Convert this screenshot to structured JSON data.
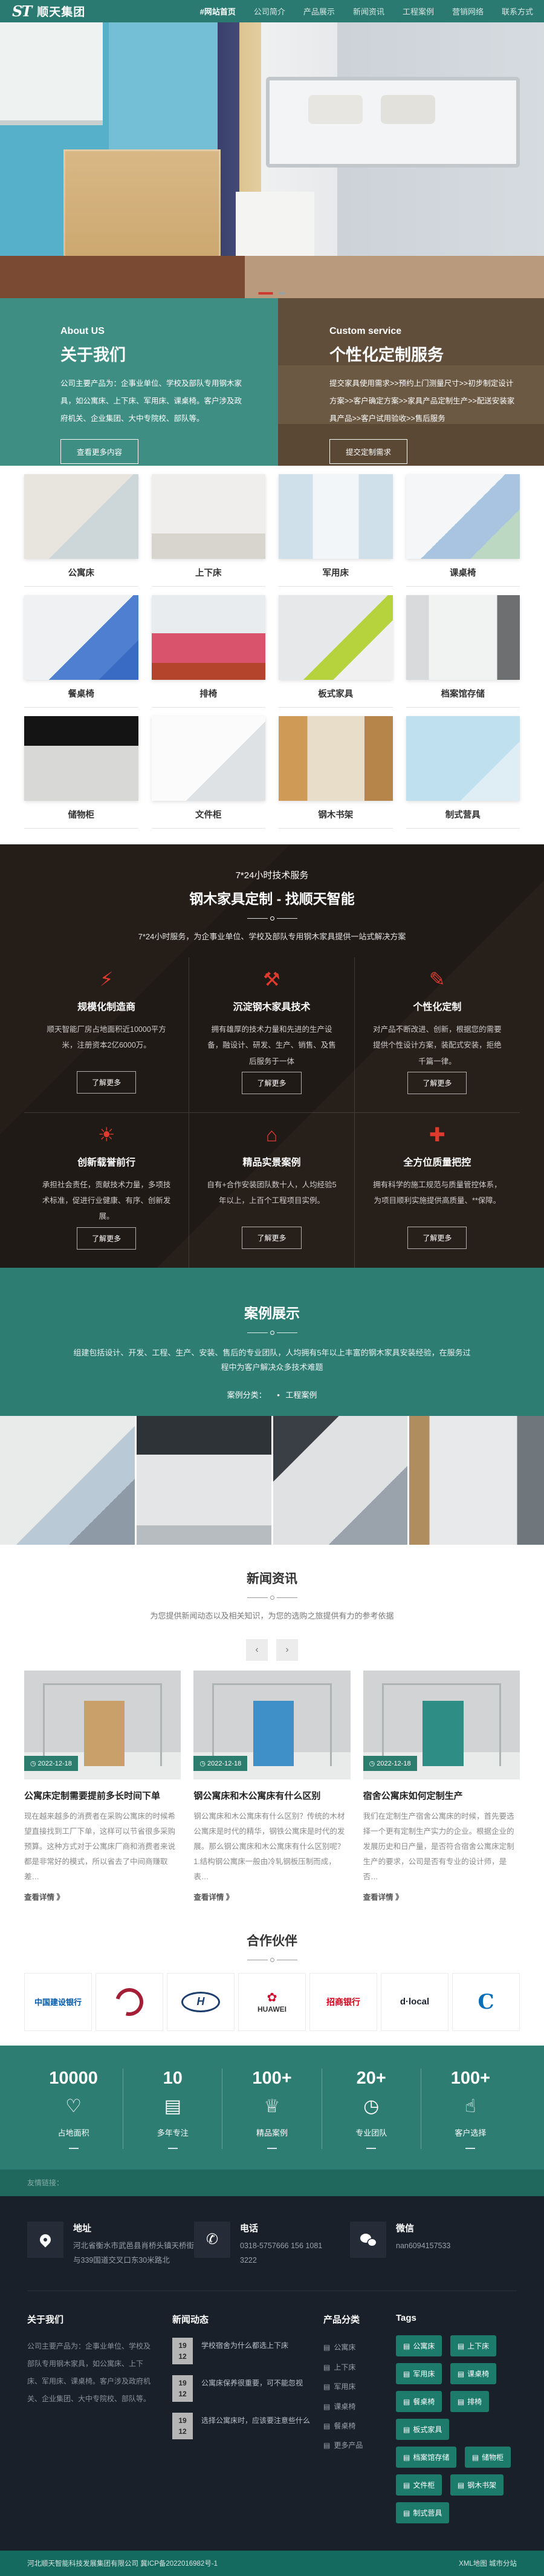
{
  "nav": {
    "logo_mark": "ST",
    "logo_text": "顺天集团",
    "items": [
      {
        "label": "#网站首页"
      },
      {
        "label": "公司简介"
      },
      {
        "label": "产品展示"
      },
      {
        "label": "新闻资讯"
      },
      {
        "label": "工程案例"
      },
      {
        "label": "营销网络"
      },
      {
        "label": "联系方式"
      }
    ]
  },
  "about": {
    "left": {
      "en": "About US",
      "title": "关于我们",
      "text": "公司主要产品为：企事业单位、学校及部队专用钢木家具，如公寓床、上下床、军用床、课桌椅。客户涉及政府机关、企业集团、大中专院校、部队等。",
      "button": "查看更多内容"
    },
    "right": {
      "en": "Custom service",
      "title": "个性化定制服务",
      "text": "提交家具使用需求>>预约上门测量尺寸>>初步制定设计方案>>客户确定方案>>家具产品定制生产>>配送安装家具产品>>客户试用验收>>售后服务",
      "button": "提交定制需求"
    }
  },
  "products": [
    "公寓床",
    "上下床",
    "军用床",
    "课桌椅",
    "餐桌椅",
    "排椅",
    "板式家具",
    "档案馆存储",
    "储物柜",
    "文件柜",
    "钢木书架",
    "制式营具"
  ],
  "services": {
    "small_title": "7*24小时技术服务",
    "title": "钢木家具定制 - 找顺天智能",
    "subtitle": "7*24小时服务，为企事业单位、学校及部队专用钢木家具提供一站式解决方案",
    "cards": [
      {
        "icon": "plug-icon",
        "glyph": "⚡",
        "title": "规模化制造商",
        "text": "顺天智能厂房占地面积近10000平方米，注册资本2亿6000万。",
        "button": "了解更多"
      },
      {
        "icon": "hammer-icon",
        "glyph": "⚒",
        "title": "沉淀钢木家具技术",
        "text": "拥有雄厚的技术力量和先进的生产设备，融设计、研发、生产、销售、及售后服务于一体",
        "button": "了解更多"
      },
      {
        "icon": "paint-roller-icon",
        "glyph": "✎",
        "title": "个性化定制",
        "text": "对产品不断改进、创新，根据您的需要提供个性设计方案，装配式安装，拒绝千篇一律。",
        "button": "了解更多"
      },
      {
        "icon": "sun-icon",
        "glyph": "☀",
        "title": "创新载誉前行",
        "text": "承担社会责任，贡献技术力量，多项技术标准，促进行业健康、有序、创新发展。",
        "button": "了解更多"
      },
      {
        "icon": "house-icon",
        "glyph": "⌂",
        "title": "精品实景案例",
        "text": "自有+合作安装团队数十人，人均经验5年以上，上百个工程项目实例。",
        "button": "了解更多"
      },
      {
        "icon": "extinguisher-icon",
        "glyph": "✚",
        "title": "全方位质量把控",
        "text": "拥有科学的施工规范与质量管控体系，为项目顺利实施提供高质量、**保障。",
        "button": "了解更多"
      }
    ]
  },
  "cases": {
    "title": "案例展示",
    "subtitle": "组建包括设计、开发、工程、生产、安装、售后的专业团队，人均拥有5年以上丰富的钢木家具安装经验，在服务过程中为客户解决众多技术难题",
    "filter_label": "案例分类：",
    "filter_bullet": "•",
    "filter_value": "工程案例"
  },
  "news": {
    "title": "新闻资讯",
    "subtitle": "为您提供新闻动态以及相关知识，为您的选购之旅提供有力的参考依据",
    "prev": "‹",
    "next": "›",
    "items": [
      {
        "date": "◷ 2022-12-18",
        "title": "公寓床定制需要提前多长时间下单",
        "text": "现在越来越多的消费者在采购公寓床的时候希望直接找到工厂下单，这样可以节省很多采购预算。这种方式对于公寓床厂商和消费者来说都是非常好的模式，所以省去了中间商赚取差…",
        "more": "查看详情 》"
      },
      {
        "date": "◷ 2022-12-18",
        "title": "钢公寓床和木公寓床有什么区别",
        "text": "钢公寓床和木公寓床有什么区别？传统的木材公寓床是时代的精华，钢铁公寓床是时代的发展。那么钢公寓床和木公寓床有什么区别呢？1.结构钢公寓床一般由冷轧钢板压制而成，表…",
        "more": "查看详情 》"
      },
      {
        "date": "◷ 2022-12-18",
        "title": "宿舍公寓床如何定制生产",
        "text": "我们在定制生产宿舍公寓床的时候，首先要选择一个更有定制生产实力的企业。根据企业的发展历史和日产量，是否符合宿舍公寓床定制生产的要求，公司是否有专业的设计师，是否…",
        "more": "查看详情 》"
      }
    ]
  },
  "partners": {
    "title": "合作伙伴",
    "logos": [
      {
        "name": "china-construction-bank",
        "text": "中国建设银行"
      },
      {
        "name": "red-emblem",
        "text": ""
      },
      {
        "name": "hyundai",
        "text": "H"
      },
      {
        "name": "huawei",
        "flower": "✿",
        "text": "HUAWEI"
      },
      {
        "name": "china-merchants-bank",
        "text": "招商银行"
      },
      {
        "name": "dlocal",
        "text": "d·local"
      },
      {
        "name": "c-logo",
        "text": "C"
      }
    ]
  },
  "stats": {
    "items": [
      {
        "value": "10000",
        "icon": "heart-icon",
        "glyph": "♡",
        "label": "占地面积"
      },
      {
        "value": "10",
        "icon": "clipboard-icon",
        "glyph": "▤",
        "label": "多年专注"
      },
      {
        "value": "100+",
        "icon": "crown-icon",
        "glyph": "♕",
        "label": "精品案例"
      },
      {
        "value": "20+",
        "icon": "stopwatch-icon",
        "glyph": "◷",
        "label": "专业团队"
      },
      {
        "value": "100+",
        "icon": "thumb-up-icon",
        "glyph": "☝",
        "label": "客户选择"
      }
    ]
  },
  "links_strip": {
    "label": "友情链接："
  },
  "footer": {
    "contacts": [
      {
        "icon": "location-pin-icon",
        "title": "地址",
        "text": "河北省衡水市武邑县肖桥头镇天桥街与339国道交叉口东30米路北"
      },
      {
        "icon": "phone-icon",
        "title": "电话",
        "text": "0318-5757666 156 1081 3222"
      },
      {
        "icon": "wechat-icon",
        "title": "微信",
        "text": "nan6094157533"
      }
    ],
    "about": {
      "title": "关于我们",
      "text": "公司主要产品为：企事业单位、学校及部队专用钢木家具，如公寓床、上下床、军用床、课桌椅。客户涉及政府机关、企业集团、大中专院校、部队等。"
    },
    "news": {
      "title": "新闻动态",
      "items": [
        {
          "day": "19",
          "month": "12",
          "title": "学校宿舍为什么都选上下床"
        },
        {
          "day": "19",
          "month": "12",
          "title": "公寓床保养很重要，可不能忽视"
        },
        {
          "day": "19",
          "month": "12",
          "title": "选择公寓床时，应该要注意些什么"
        }
      ]
    },
    "categories": {
      "title": "产品分类",
      "icon_glyph": "▤",
      "items": [
        "公寓床",
        "上下床",
        "军用床",
        "课桌椅",
        "餐桌椅",
        "更多产品"
      ]
    },
    "tags": {
      "title": "Tags",
      "icon_glyph": "▤",
      "items": [
        "公寓床",
        "上下床",
        "军用床",
        "课桌椅",
        "餐桌椅",
        "排椅",
        "板式家具",
        "档案馆存储",
        "储物柜",
        "文件柜",
        "钢木书架",
        "制式营具"
      ]
    },
    "bottom": {
      "left": "河北顺天智能科技发展集团有限公司 冀ICP备2022016982号-1",
      "right": "XML地图 城市分站"
    }
  }
}
